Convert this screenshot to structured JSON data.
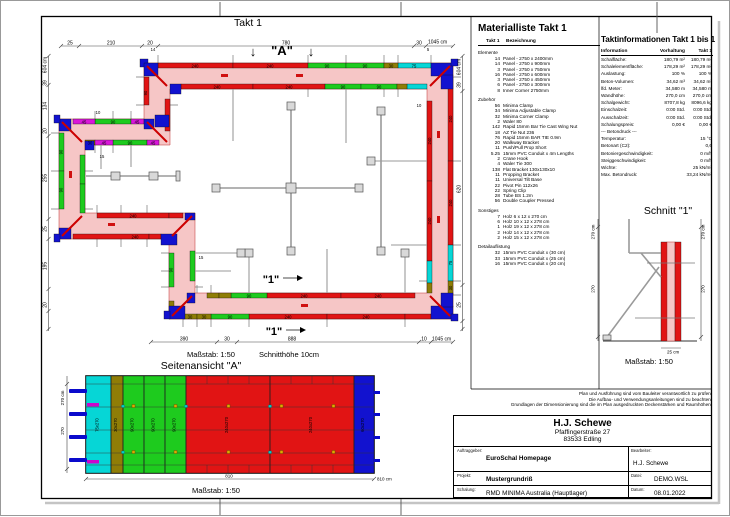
{
  "colors": {
    "panel_red": "#e11414",
    "panel_green": "#1ecb1e",
    "panel_cyan": "#06d6d6",
    "panel_blue": "#1212cf",
    "panel_magenta": "#da16da",
    "panel_olive": "#8f7d06",
    "concrete_pink": "#f6c6c6"
  },
  "page": {
    "takt_title": "Takt 1",
    "plan_scale": "Maßstab: 1:50",
    "plan_cut_height": "Schnitthöhe 10cm"
  },
  "plan": {
    "marker_a": "\"A\"",
    "arrow_down": "↓",
    "marker_1": "\"1\"",
    "dims": {
      "top": [
        "25",
        "210",
        "20",
        "780",
        "30"
      ],
      "top_total": "1045 cm",
      "bottom": [
        "390",
        "30",
        "888",
        "10"
      ],
      "bottom_total": "1045 cm",
      "left": [
        "39",
        "134",
        "20",
        "255",
        "25",
        "195",
        "20"
      ],
      "left_total": "604 cm",
      "right": [
        "39",
        "620",
        "25"
      ],
      "right_total": "604 cm"
    },
    "panels": {
      "p240": "240",
      "p90": "90",
      "p75": "75",
      "p45": "45",
      "p30": "30"
    },
    "small": {
      "a": "10",
      "b": "15",
      "c": "14",
      "d": "5",
      "e": "15",
      "f": "10"
    }
  },
  "materialliste": {
    "title": "Materialliste  Takt 1",
    "col_qty": "Takt 1",
    "col_name": "Bezeichnung",
    "sections": [
      {
        "name": "Elemente",
        "items": [
          [
            "14",
            "Panel - 2750 x 2400mm"
          ],
          [
            "14",
            "Panel - 2750 x 900mm"
          ],
          [
            "3",
            "Panel - 2750 x 750mm"
          ],
          [
            "16",
            "Panel - 2750 x 600mm"
          ],
          [
            "3",
            "Panel - 2750 x 450mm"
          ],
          [
            "6",
            "Panel - 2750 x 300mm"
          ],
          [
            "8",
            "Inner Corner 2750mm"
          ]
        ]
      },
      {
        "name": "Zubehör",
        "items": [
          [
            "56",
            "Minima Clamp"
          ],
          [
            "34",
            "Minima Adjustable Clamp"
          ],
          [
            "32",
            "Minima Corner Clamp"
          ],
          [
            "2",
            "Waler 80"
          ],
          [
            "142",
            "Rapid 15mm Bar Tie Cast Wing Nut"
          ],
          [
            "18",
            "AZ Tie Nut 236"
          ],
          [
            "76",
            "Rapid 15mm BAR TIE 0.9m"
          ],
          [
            "20",
            "Walkway Bracket"
          ],
          [
            "11",
            "Push/Pull Prop Short"
          ],
          [
            "5.25",
            "15mm PVC Conduit x 4m Lengths"
          ],
          [
            "2",
            "Crane Hook"
          ],
          [
            "4",
            "Waler Tie 300"
          ],
          [
            "138",
            "Flat Bracket 130x130x10"
          ],
          [
            "11",
            "Propping Bracket"
          ],
          [
            "11",
            "Universal Tilt Base"
          ],
          [
            "22",
            "Pivot Pin 112x26"
          ],
          [
            "22",
            "Spring Clip"
          ],
          [
            "28",
            "Tube BS 1.2m"
          ],
          [
            "56",
            "Double Coupler Pressed"
          ]
        ]
      },
      {
        "name": "Sonstiges",
        "items": [
          [
            "7",
            "Holz 6 x 12 x 270 cm"
          ],
          [
            "6",
            "Holz 10 x 12 x 278 cm"
          ],
          [
            "1",
            "Holz 19 x 12 x 278 cm"
          ],
          [
            "2",
            "Holz 14 x 12 x 278 cm"
          ],
          [
            "2",
            "Holz 15 x 12 x 278 cm"
          ]
        ]
      },
      {
        "name": "Detailauflistung",
        "items": [
          [
            "32",
            "15mm PVC Conduit x  (30 cm)"
          ],
          [
            "33",
            "15mm PVC Conduit x  (25 cm)"
          ],
          [
            "16",
            "15mm PVC Conduit x  (20 cm)"
          ]
        ]
      }
    ]
  },
  "taktinfo": {
    "title": "Taktinformationen  Takt 1 bis 1",
    "col_info": "Information",
    "col_vorhaltung": "Vorhaltung",
    "col_takt": "Takt 1",
    "rows": [
      [
        "Schalfläche:",
        "180,79 m²",
        "180,79 m²"
      ],
      [
        "Schalelementfläche:",
        "178,29 m²",
        "178,29 m²"
      ],
      [
        "Auslastung:",
        "100 %",
        "100 %"
      ],
      [
        "Beton-Volumen:",
        "34,62 m³",
        "34,62 m³"
      ],
      [
        "lfd. Meter:",
        "34,580 m",
        "34,580 m"
      ],
      [
        "Wandhöhe:",
        "270,0 cm",
        "270,0 cm"
      ],
      [
        "Schalgewicht:",
        "8707,8 kg",
        "8096,6 kg"
      ],
      [
        "Einschalzeit:",
        "0:00 Std.",
        "0:00 Std."
      ],
      [
        "Ausschalzeit:",
        "0:00 Std.",
        "0:00 Std."
      ],
      [
        "Schalungspreis:",
        "0,00 €",
        "0,00 €"
      ],
      [
        "--- Betondruck ---",
        "",
        ""
      ],
      [
        "Temperatur:",
        "",
        "15 °C"
      ],
      [
        "Betonart (C2):",
        "",
        "0,6"
      ],
      [
        "Betoniergeschwindigkeit:",
        "",
        "0 m/h"
      ],
      [
        "Steiggeschwindigkeit:",
        "",
        "0 m/h"
      ],
      [
        "Wichte:",
        "",
        "25 kN/m³"
      ],
      [
        "Max. Betondruck:",
        "",
        "33,24 kN/m²"
      ]
    ]
  },
  "schnitt": {
    "title": "Schnitt \"1\"",
    "scale": "Maßstab: 1:50",
    "dim_height_cm": "270 cm",
    "dim_height": "270",
    "dim_width": "25 cm"
  },
  "seitenansicht": {
    "title": "Seitenansicht \"A\"",
    "scale": "Maßstab: 1:50",
    "dim_height_cm": "270 cm",
    "dim_height": "270",
    "dim_width": "810",
    "dim_width_cm": "810 cm",
    "panels": [
      "75x270",
      "30x270",
      "90x270",
      "90x270",
      "90x270",
      "240x270",
      "240x270",
      "60x270"
    ]
  },
  "disclaimer": {
    "l1": "Plan und Ausführung sind vom Bauleiter verantwortlich zu prüfen!",
    "l2": "Die Aufbau- und Verwendungsanleitungen sind zu beachten!",
    "l3": "Grundlagen der Dimensionierung sind die im Plan ausgedruckten Deckenstärken und Raumhöhen."
  },
  "titleblock": {
    "company": "H.J. Schewe",
    "street": "Pfaffingerstraße 27",
    "city": "83533 Edling",
    "lbl_auftraggeber": "Auftraggeber:",
    "auftraggeber": "EuroSchal Homepage",
    "lbl_bearbeiter": "Bearbeiter:",
    "bearbeiter": "H.J. Schewe",
    "lbl_projekt": "Projekt:",
    "projekt": "Mustergrundriß",
    "lbl_datei": "Datei:",
    "datei": "DEMO.WSL",
    "lbl_schalung": "Schalung:",
    "schalung": "RMD MINIMA Australia (Hauptlager)",
    "lbl_datum": "Datum:",
    "datum": "08.01.2022"
  }
}
